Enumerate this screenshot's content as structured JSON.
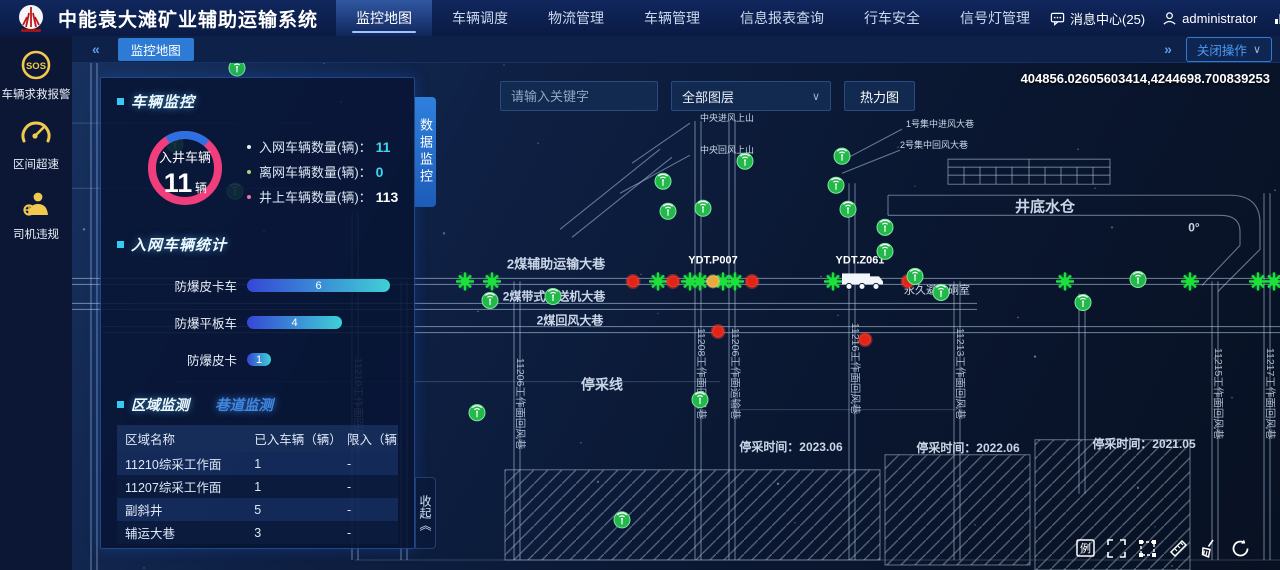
{
  "topbar": {
    "title": "中能袁大滩矿业辅助运输系统",
    "nav": [
      {
        "label": "监控地图",
        "active": true
      },
      {
        "label": "车辆调度",
        "active": false
      },
      {
        "label": "物流管理",
        "active": false
      },
      {
        "label": "车辆管理",
        "active": false
      },
      {
        "label": "信息报表查询",
        "active": false
      },
      {
        "label": "行车安全",
        "active": false
      },
      {
        "label": "信号灯管理",
        "active": false
      }
    ],
    "message_center": "消息中心(25)",
    "user": "administrator",
    "go_backend": "前往后台"
  },
  "sidebar": {
    "items": [
      {
        "icon": "sos-icon",
        "label": "车辆求救报警"
      },
      {
        "icon": "overspeed-icon",
        "label": "区间超速"
      },
      {
        "icon": "driver-violation-icon",
        "label": "司机违规"
      }
    ]
  },
  "tabbar": {
    "collapse_left": "«",
    "active_tab": "监控地图",
    "collapse_right": "»",
    "close_ops": "关闭操作",
    "chevron": "∨"
  },
  "map_toolbar": {
    "search_placeholder": "请输入关键字",
    "layer_select": "全部图层",
    "heatmap_button": "热力图",
    "coordinates": "404856.02605603414,4244698.700839253"
  },
  "panel": {
    "data_tab_vertical": "数据监控",
    "collapse_vertical": "收起《",
    "vehicle_monitor": {
      "title": "车辆监控",
      "gauge": {
        "label": "入井车辆",
        "value": "11",
        "unit": "辆"
      },
      "stats": [
        {
          "label": "入网车辆数量(辆)：",
          "value": "11",
          "dot": "#e8eef8",
          "color": "#3fd6f0"
        },
        {
          "label": "离网车辆数量(辆)：",
          "value": "0",
          "dot": "#a8d878",
          "color": "#3fd6f0"
        },
        {
          "label": "井上车辆数量(辆)：",
          "value": "113",
          "dot": "#e878a8",
          "color": "#ffffff"
        }
      ]
    },
    "network_stats": {
      "title": "入网车辆统计",
      "max": 6,
      "bars": [
        {
          "label": "防爆皮卡车",
          "value": 6
        },
        {
          "label": "防爆平板车",
          "value": 4
        },
        {
          "label": "防爆皮卡",
          "value": 1
        }
      ]
    },
    "area_monitor": {
      "tabs": [
        {
          "label": "区域监测",
          "active": true
        },
        {
          "label": "巷道监测",
          "active": false
        }
      ],
      "table": {
        "headers": [
          "区域名称",
          "已入车辆（辆）",
          "限入（辆）"
        ],
        "rows": [
          [
            "11210综采工作面",
            "1",
            "-"
          ],
          [
            "11207综采工作面",
            "1",
            "-"
          ],
          [
            "副斜井",
            "5",
            "-"
          ],
          [
            "辅运大巷",
            "3",
            "-"
          ]
        ]
      }
    }
  },
  "map_tools": [
    {
      "name": "legend",
      "glyph": "例"
    },
    {
      "name": "fullscreen",
      "glyph": ""
    },
    {
      "name": "box-select",
      "glyph": ""
    },
    {
      "name": "measure",
      "glyph": ""
    },
    {
      "name": "clear",
      "glyph": ""
    },
    {
      "name": "refresh",
      "glyph": ""
    }
  ],
  "colors": {
    "accent_blue": "#2e7bd6",
    "cyan": "#3fd6f0",
    "gauge_pink": "#ef3e7b",
    "gauge_blue": "#2f6fe4",
    "marker_green": "#1de03c",
    "marker_red": "#e02418",
    "marker_orange": "#e8a83c",
    "sidebar_icon_yellow": "#f0c94e"
  },
  "map": {
    "dbl_h": [
      [
        218,
        0,
        1208
      ],
      [
        243,
        0,
        905
      ],
      [
        266,
        30,
        1208
      ]
    ],
    "dbl_v": [
      [
        22,
        0,
        506
      ],
      [
        283,
        150,
        496
      ],
      [
        332,
        218,
        496
      ],
      [
        445,
        218,
        496
      ],
      [
        626,
        58,
        496
      ],
      [
        660,
        58,
        496
      ],
      [
        780,
        120,
        496
      ],
      [
        885,
        218,
        496
      ],
      [
        1010,
        230,
        430
      ],
      [
        1143,
        218,
        496
      ],
      [
        1195,
        130,
        496
      ]
    ],
    "singles": [
      [
        100,
        318,
        648,
        318
      ],
      [
        283,
        496,
        1208,
        496
      ],
      [
        660,
        346,
        885,
        346
      ],
      [
        0,
        60,
        240,
        60
      ],
      [
        0,
        125,
        252,
        125
      ]
    ],
    "paths": [
      "M816,132 L1158,132 Q1188,132 1188,160 L1188,186",
      "M816,152 L1148,152 Q1168,152 1168,168 L1168,182",
      "M816,132 L816,152",
      "M1188,186 L1146,228",
      "M1168,182 L1130,222",
      "M876,96 h162 v25 h-162 z",
      "M876,104 h162",
      "M876,112 h162",
      "M957,96 v25",
      "M892,104 v17",
      "M908,104 v17",
      "M924,104 v17",
      "M940,104 v17",
      "M973,104 v17",
      "M989,104 v17",
      "M1005,104 v17",
      "M1021,104 v17",
      "M488,166 L588,86",
      "M500,174 L600,94",
      "M618,60 L560,100",
      "M618,92 L548,130",
      "M830,66 L775,95",
      "M828,87 L770,110"
    ],
    "hatches": [
      [
        433,
        406,
        375,
        90
      ],
      [
        813,
        391,
        145,
        110
      ],
      [
        963,
        376,
        155,
        130
      ]
    ],
    "labels": [
      {
        "t": "2煤辅助运输大巷",
        "x": 484,
        "y": 205,
        "s": 13,
        "b": 1
      },
      {
        "t": "2煤带式输送机大巷",
        "x": 482,
        "y": 237,
        "s": 12,
        "b": 1
      },
      {
        "t": "2煤回风大巷",
        "x": 498,
        "y": 261,
        "s": 12,
        "b": 1
      },
      {
        "t": "停采线",
        "x": 530,
        "y": 326,
        "s": 14,
        "b": 1
      },
      {
        "t": "停采时间：2023.06",
        "x": 719,
        "y": 387,
        "s": 12,
        "b": 1
      },
      {
        "t": "停采时间：2022.06",
        "x": 896,
        "y": 388,
        "s": 12,
        "b": 1
      },
      {
        "t": "停采时间：2021.05",
        "x": 1072,
        "y": 384,
        "s": 12,
        "b": 1
      },
      {
        "t": "井底水仓",
        "x": 973,
        "y": 148,
        "s": 15,
        "b": 1
      },
      {
        "t": "永久避难硐室",
        "x": 865,
        "y": 230,
        "s": 11,
        "b": 0
      },
      {
        "t": "中央进风上山",
        "x": 655,
        "y": 58,
        "s": 9,
        "b": 0
      },
      {
        "t": "中央回风上山",
        "x": 655,
        "y": 90,
        "s": 9,
        "b": 0
      },
      {
        "t": "1号集中进风大巷",
        "x": 868,
        "y": 64,
        "s": 9,
        "b": 0
      },
      {
        "t": "2号集中回风大巷",
        "x": 862,
        "y": 85,
        "s": 9,
        "b": 0
      },
      {
        "t": "0°",
        "x": 1122,
        "y": 168,
        "s": 12,
        "b": 1
      },
      {
        "t": "YDT.P007",
        "x": 641,
        "y": 200,
        "s": 11,
        "b": 1,
        "w": 1
      },
      {
        "t": "YDT.Z061",
        "x": 788,
        "y": 200,
        "s": 11,
        "b": 1,
        "w": 1
      }
    ],
    "vlabels": [
      {
        "t": "11210工作面回风巷",
        "x": 283,
        "y": 340
      },
      {
        "t": "11206工作面回风巷",
        "x": 445,
        "y": 340
      },
      {
        "t": "11208工作面回风巷",
        "x": 626,
        "y": 310
      },
      {
        "t": "11206工作面运输巷",
        "x": 660,
        "y": 310
      },
      {
        "t": "11216工作面回风巷",
        "x": 780,
        "y": 305
      },
      {
        "t": "11213工作面回风巷",
        "x": 885,
        "y": 310
      },
      {
        "t": "11215工作面回风巷",
        "x": 1143,
        "y": 330
      },
      {
        "t": "11217工作面回风巷",
        "x": 1195,
        "y": 330
      }
    ],
    "bursts": [
      [
        393,
        218
      ],
      [
        420,
        218
      ],
      [
        586,
        218
      ],
      [
        618,
        218
      ],
      [
        628,
        218
      ],
      [
        651,
        218
      ],
      [
        663,
        218
      ],
      [
        761,
        218
      ],
      [
        993,
        218
      ],
      [
        1118,
        218
      ],
      [
        1186,
        218
      ],
      [
        1202,
        218
      ]
    ],
    "reds": [
      [
        561,
        218
      ],
      [
        601,
        218
      ],
      [
        680,
        218
      ],
      [
        836,
        218
      ],
      [
        646,
        268
      ],
      [
        793,
        276
      ]
    ],
    "orange": [
      641,
      218
    ],
    "beacons": [
      [
        165,
        5
      ],
      [
        103,
        81
      ],
      [
        163,
        128
      ],
      [
        418,
        237
      ],
      [
        481,
        233
      ],
      [
        591,
        118
      ],
      [
        596,
        148
      ],
      [
        631,
        145
      ],
      [
        673,
        98
      ],
      [
        764,
        122
      ],
      [
        770,
        93
      ],
      [
        776,
        146
      ],
      [
        813,
        164
      ],
      [
        813,
        188
      ],
      [
        843,
        213
      ],
      [
        869,
        229
      ],
      [
        1011,
        239
      ],
      [
        1066,
        216
      ],
      [
        405,
        349
      ],
      [
        628,
        336
      ],
      [
        550,
        456
      ]
    ],
    "truck": [
      770,
      208
    ]
  }
}
